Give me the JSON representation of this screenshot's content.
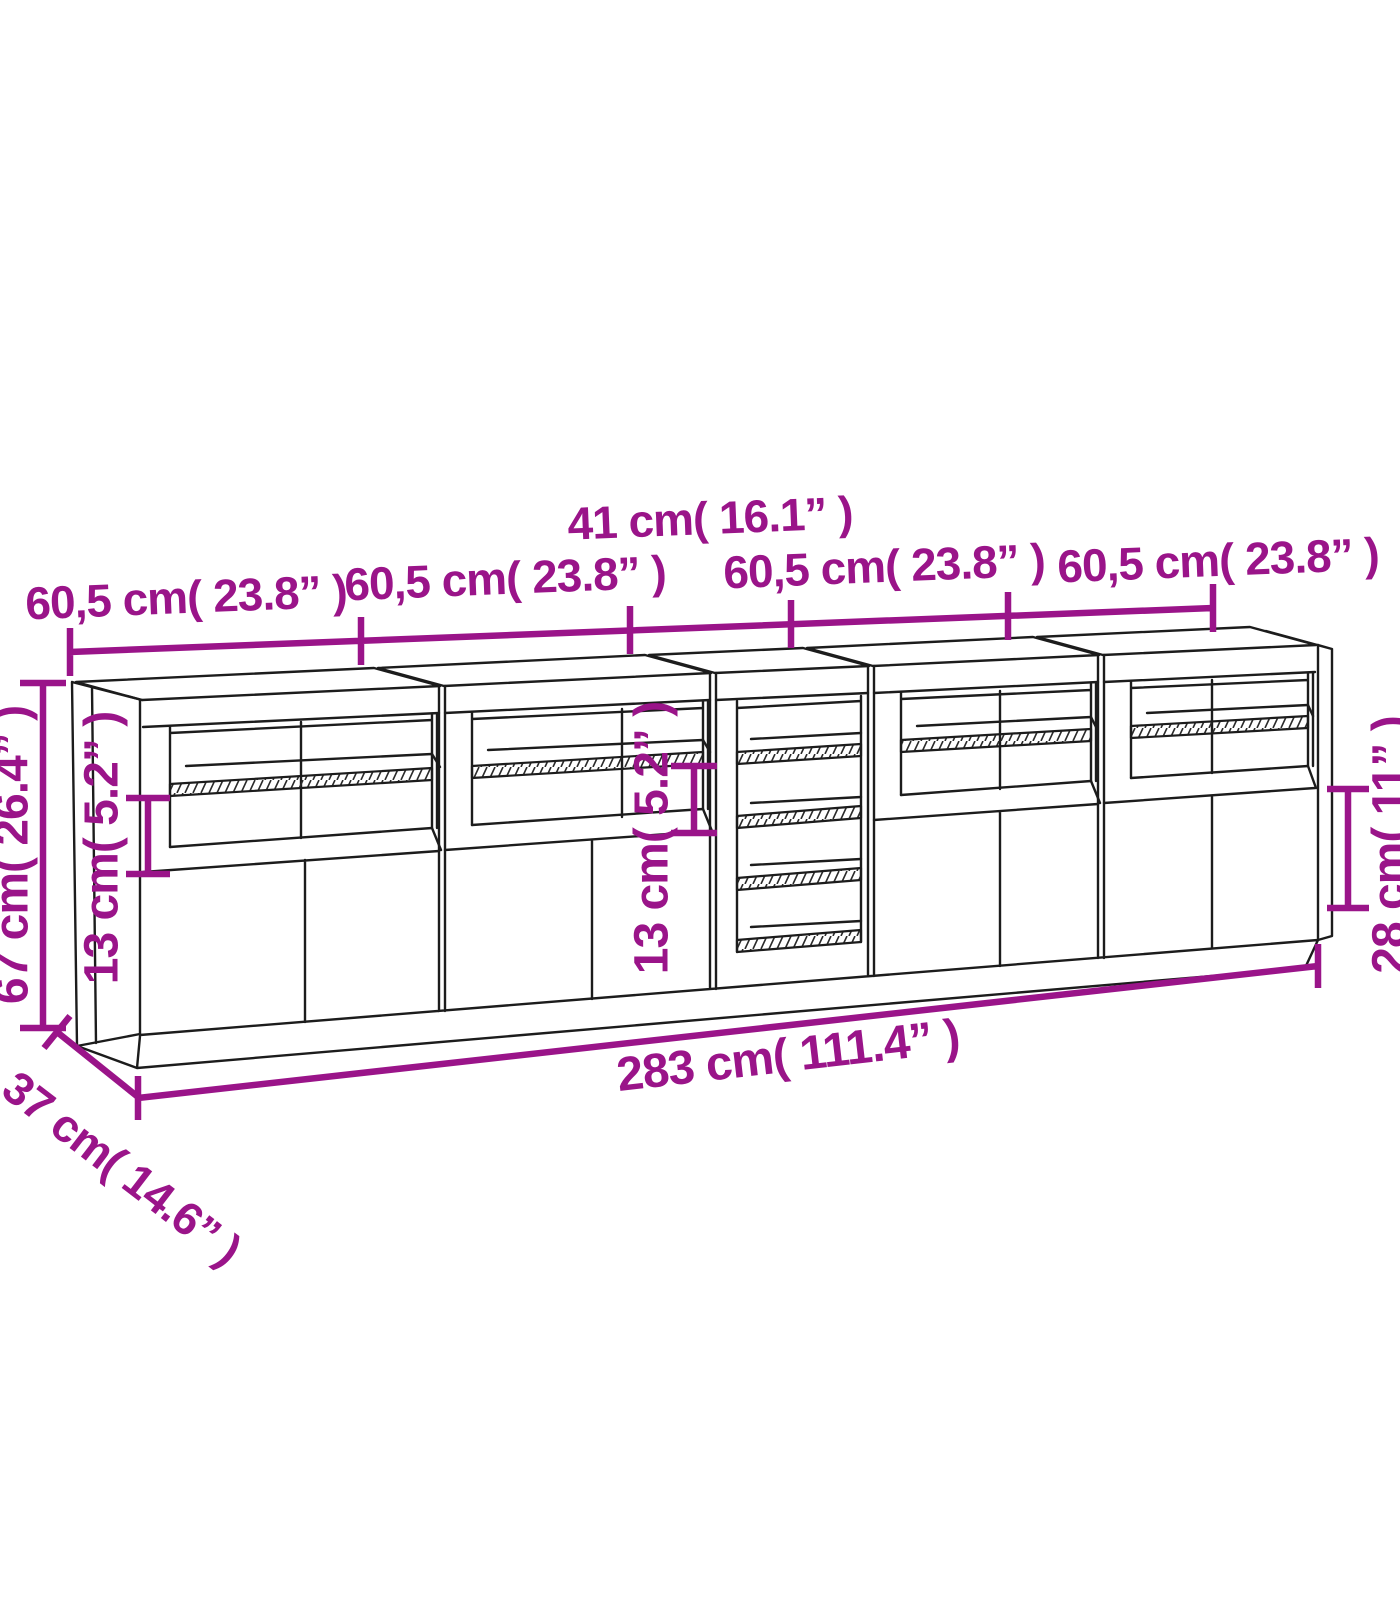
{
  "title": "Sideboard dimension diagram",
  "colors": {
    "accent": "#9a1489",
    "line": "#1c1c1c",
    "background": "#ffffff"
  },
  "dimensions": {
    "top_segments": [
      "60,5 cm( 23.8” )",
      "60,5 cm( 23.8” )",
      "60,5 cm( 23.8” )",
      "60,5 cm( 23.8” )"
    ],
    "middle_width": "41 cm( 16.1” )",
    "total_height": "67 cm( 26.4” )",
    "left_shelf_spacing": "13 cm( 5.2” )",
    "middle_shelf_spacing": "13 cm( 5.2” )",
    "door_height": "28 cm( 11” )",
    "total_width": "283 cm( 111.4” )",
    "depth": "37 cm( 14.6” )"
  }
}
